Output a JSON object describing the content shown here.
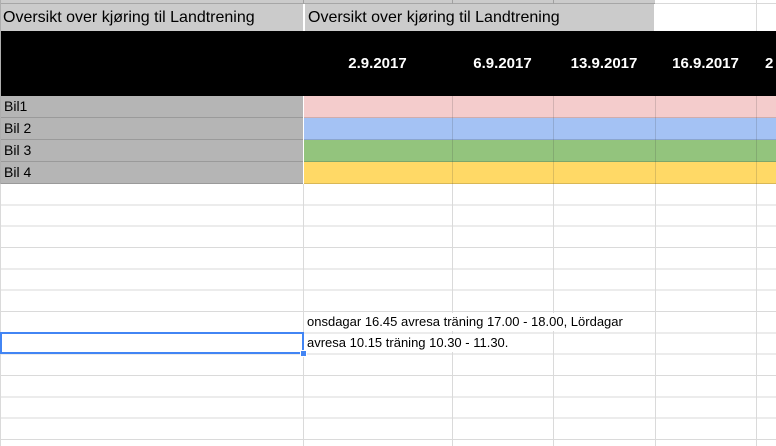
{
  "sheet": {
    "header": {
      "title_a": "Oversikt over kjøring til Landtrening",
      "title_b": "Oversikt over kjøring til Landtrening"
    },
    "date_columns": [
      "2.9.2017",
      "6.9.2017",
      "13.9.2017",
      "16.9.2017",
      "2"
    ],
    "car_rows": [
      {
        "label": "Bil1",
        "color": "#f4cccc"
      },
      {
        "label": "Bil 2",
        "color": "#a4c2f4"
      },
      {
        "label": "Bil 3",
        "color": "#93c47d"
      },
      {
        "label": "Bil 4",
        "color": "#ffd966"
      }
    ],
    "notes": {
      "line1": "onsdagar 16.45 avresa träning 17.00 - 18.00, Lördagar",
      "line2": "avresa 10.15 träning 10.30 - 11.30."
    },
    "colors": {
      "header_bg": "#cbcbcb",
      "row_label_bg": "#b5b5b5",
      "date_band_bg": "#000000",
      "gridline": "#dadada",
      "selection_border": "#4285f4"
    }
  }
}
